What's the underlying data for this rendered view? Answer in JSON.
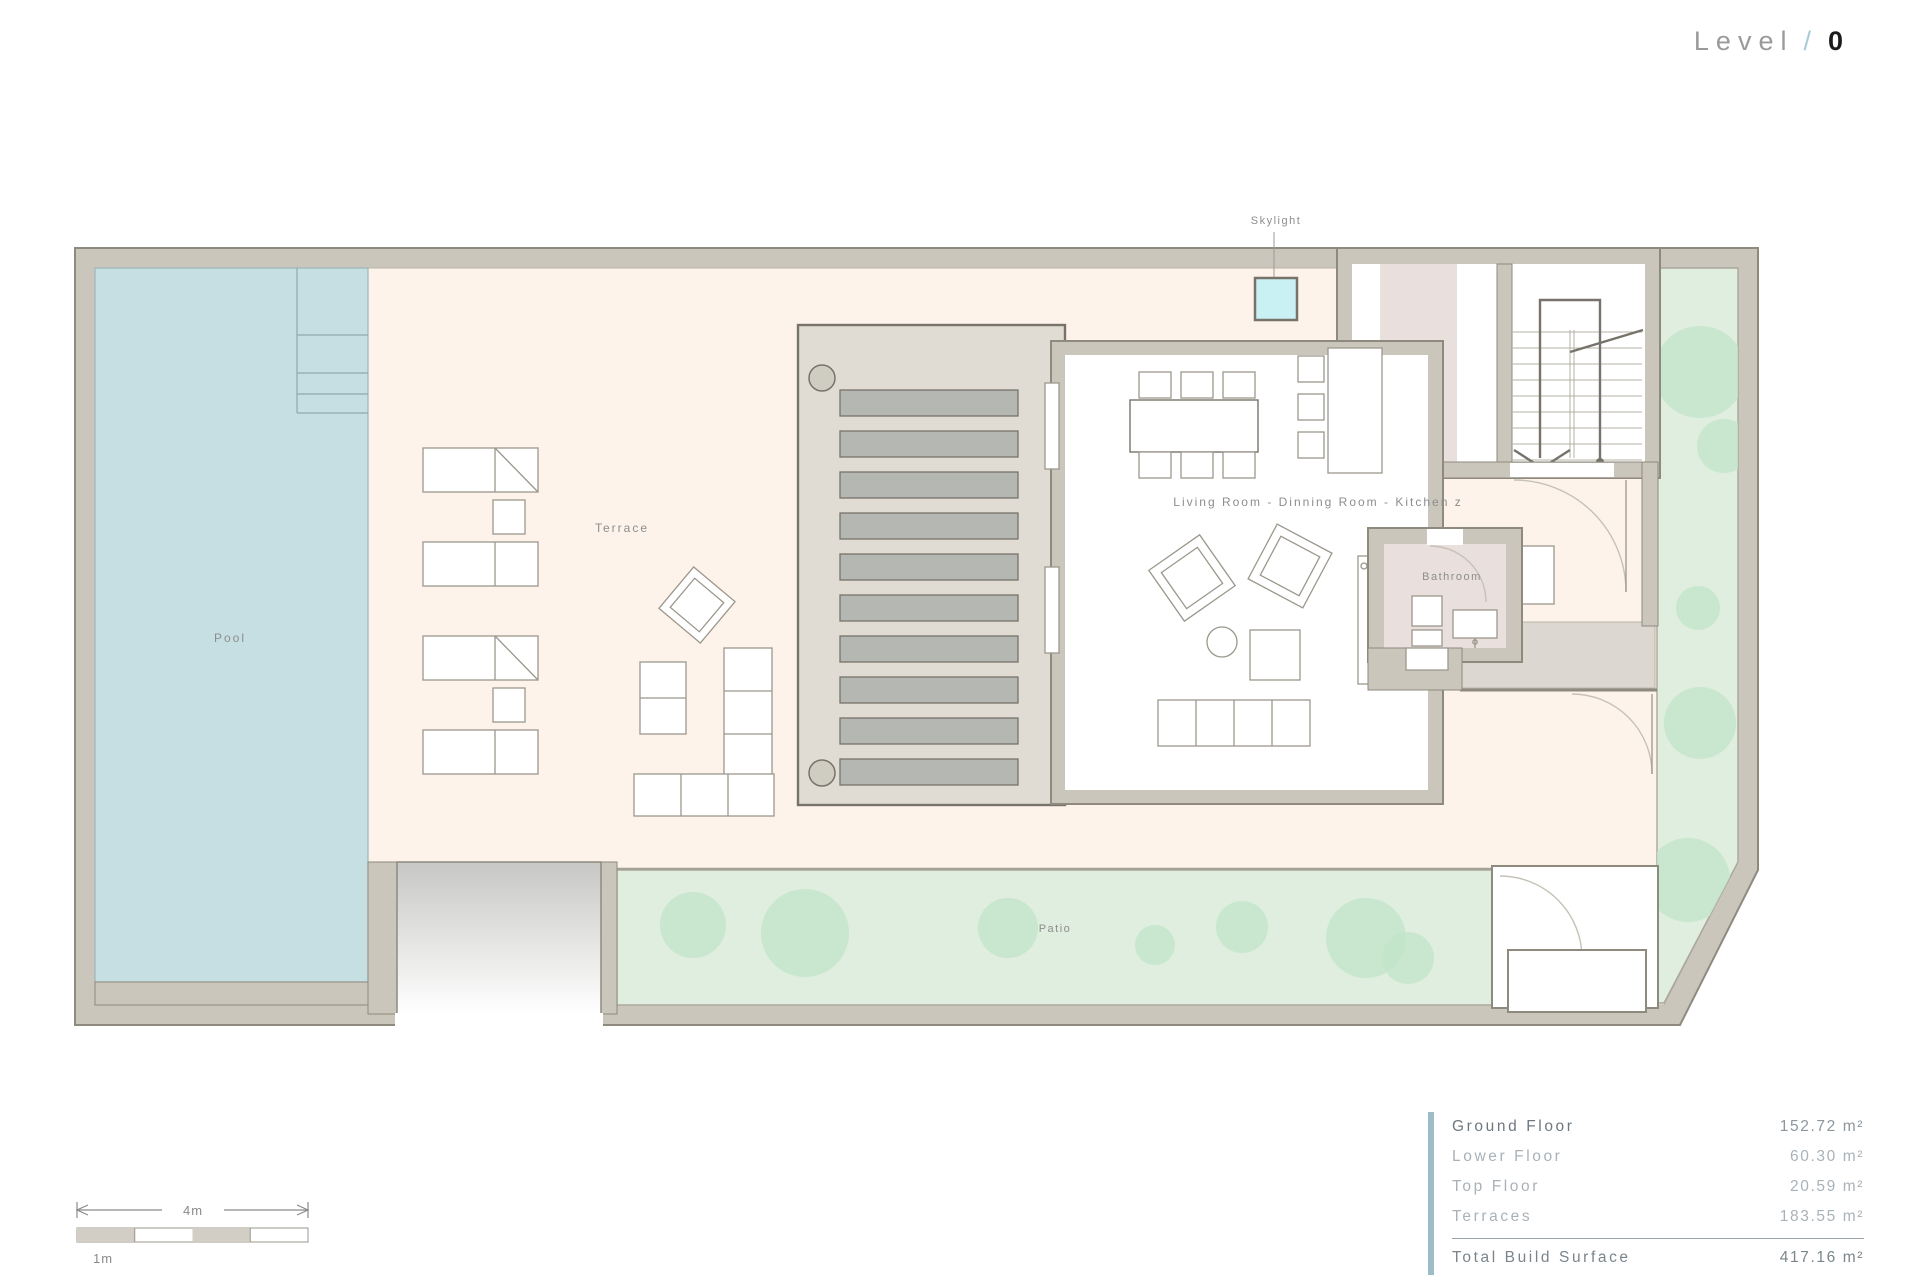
{
  "header": {
    "level_label": "Level",
    "separator": "/",
    "level_value": "0"
  },
  "plan_labels": {
    "skylight": "Skylight",
    "pool": "Pool",
    "terrace": "Terrace",
    "living": "Living Room - Dinning Room - Kitchen z",
    "bathroom": "Bathroom",
    "patio": "Patio"
  },
  "scale_bar": {
    "span_label": "4m",
    "unit_label": "1m"
  },
  "area_table": {
    "rows": [
      {
        "label": "Ground Floor",
        "value": "152.72 m²"
      },
      {
        "label": "Lower Floor",
        "value": "60.30 m²"
      },
      {
        "label": "Top Floor",
        "value": "20.59 m²"
      },
      {
        "label": "Terraces",
        "value": "183.55 m²"
      }
    ],
    "total_label": "Total Build Surface",
    "total_value": "417.16 m²"
  },
  "colors": {
    "wall": "#cbc6bb",
    "wallline": "#8e8a7e",
    "cream": "#fdf3ea",
    "pool": "#c6dfe3",
    "green": "#dfeede",
    "tree": "#c2e5c9",
    "mauve": "#e9dfdc",
    "porch": "#e0dcd3",
    "slat": "#b5b7b2",
    "dark": "#77736a",
    "furn": "#9b978c",
    "sky": "#c9f1f4",
    "label": "#8d8d8d",
    "accent": "#9dbcc8"
  }
}
